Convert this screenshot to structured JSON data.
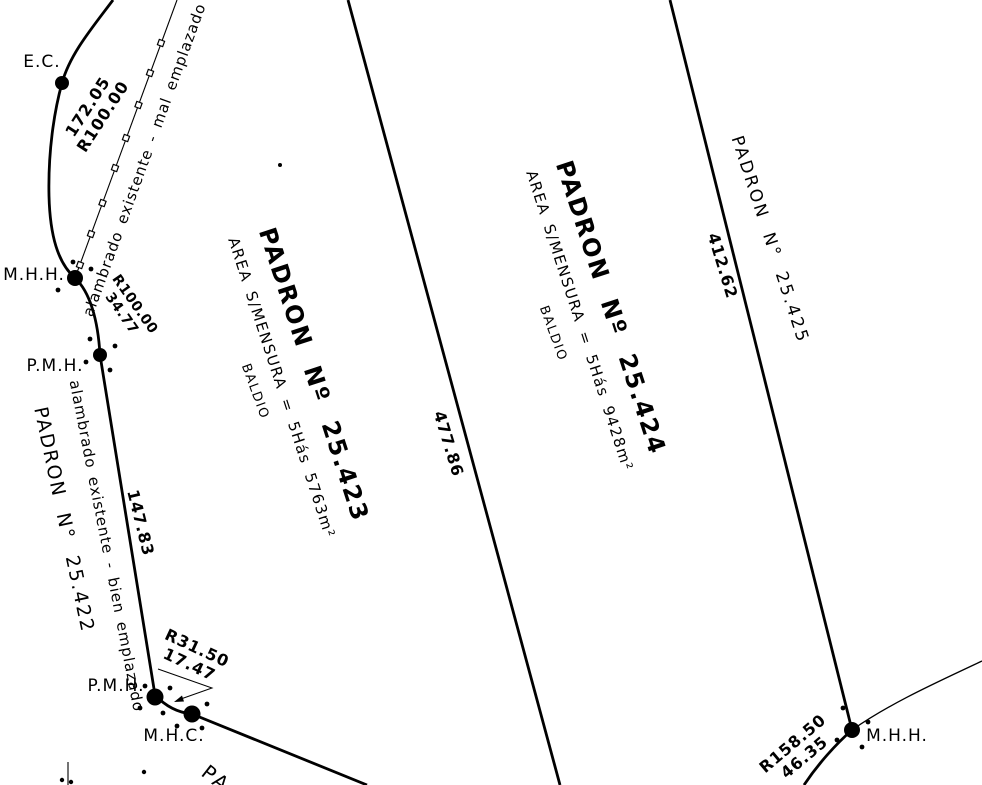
{
  "colors": {
    "ink": "#000000",
    "paper": "#ffffff"
  },
  "labels": {
    "ec": "E.C.",
    "mhh_left": "M.H.H.",
    "pmh_left": "P.M.H.",
    "pmh_bottom": "P.M.H.",
    "mhc": "M.H.C.",
    "mhh_bottom_right": "M.H.H.",
    "pa_partial": "PA"
  },
  "fences": {
    "mal": "alambrado existente - mal emplazado",
    "bien": "alambrado existente - bien emplazado"
  },
  "parcels": {
    "p422": {
      "title": "PADRON N° 25.422"
    },
    "p423": {
      "title": "PADRON Nº 25.423",
      "area": "AREA S/MENSURA = 5Hás 5763m²",
      "status": "BALDIO"
    },
    "p424": {
      "title": "PADRON Nº 25.424",
      "area": "AREA S/MENSURA = 5Hás 9428m²",
      "status": "BALDIO"
    },
    "p425": {
      "title": "PADRON N° 25.425"
    }
  },
  "dimensions": {
    "arc_ec": {
      "line1": "172.05",
      "line2": "R100.00"
    },
    "arc_mhh": {
      "line1": "R100.00",
      "line2": "34.77"
    },
    "seg_bien": "147.83",
    "arc_pmh": {
      "line1": "R31.50",
      "line2": "17.47"
    },
    "side_423": "477.86",
    "side_424": "412.62",
    "arc_br": {
      "line1": "R158.50",
      "line2": "46.35"
    }
  }
}
